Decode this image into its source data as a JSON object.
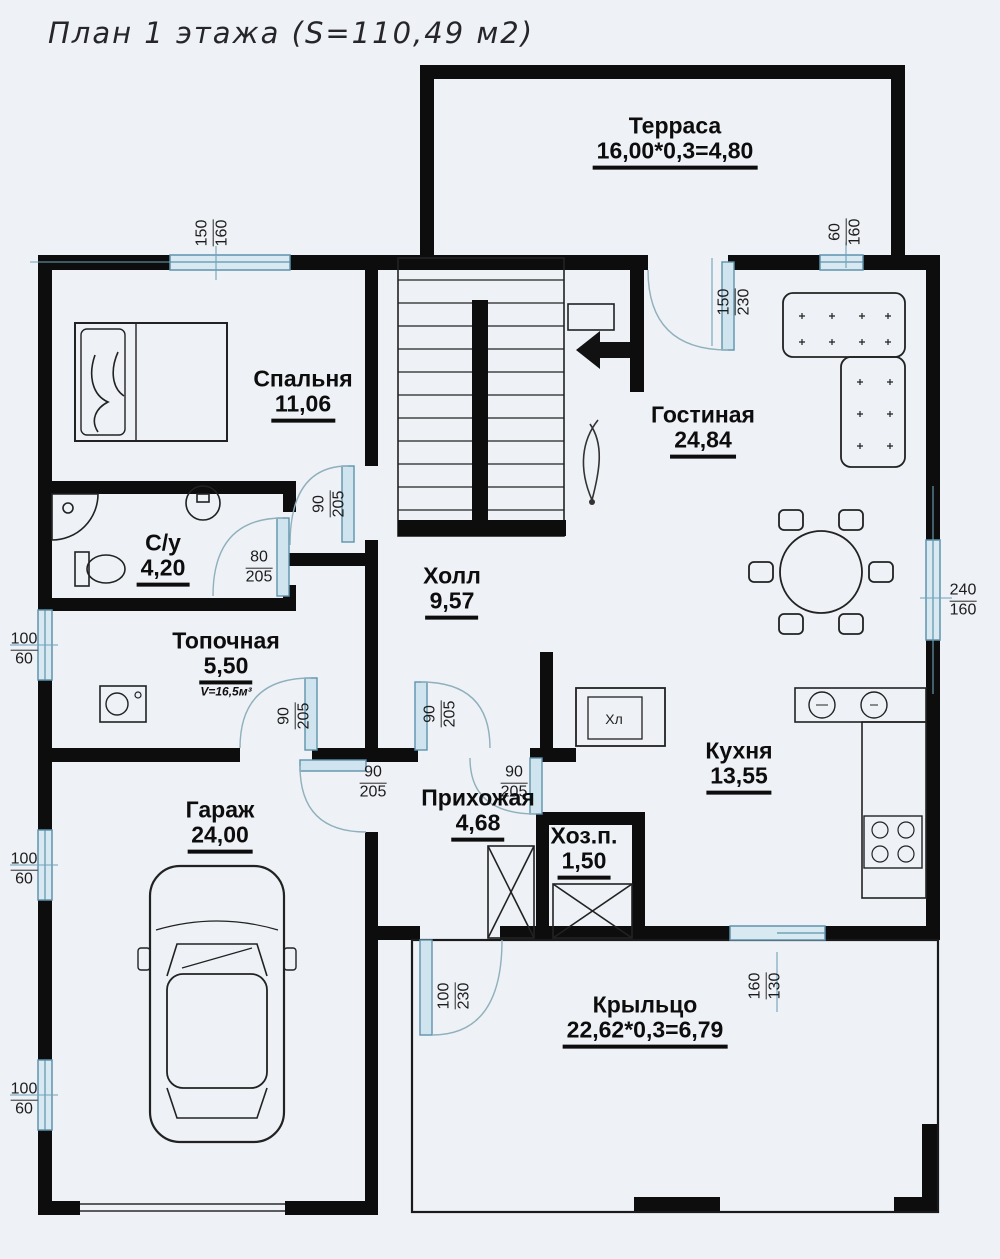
{
  "title": "План 1 этажа (S=110,49 м2)",
  "rooms": {
    "terrasa": {
      "name": "Терраса",
      "area": "16,00*0,3=4,80"
    },
    "spalnya": {
      "name": "Спальня",
      "area": "11,06"
    },
    "gostinaya": {
      "name": "Гостиная",
      "area": "24,84"
    },
    "su": {
      "name": "С/у",
      "area": "4,20"
    },
    "topochnaya": {
      "name": "Топочная",
      "area": "5,50",
      "volume": "V=16,5м³"
    },
    "holl": {
      "name": "Холл",
      "area": "9,57"
    },
    "kuhnya": {
      "name": "Кухня",
      "area": "13,55"
    },
    "garazh": {
      "name": "Гараж",
      "area": "24,00"
    },
    "prihozhaya": {
      "name": "Прихожая",
      "area": "4,68"
    },
    "hozp": {
      "name": "Хоз.п.",
      "area": "1,50"
    },
    "krylco": {
      "name": "Крыльцо",
      "area": "22,62*0,3=6,79"
    }
  },
  "dimensions": {
    "window_bedroom_top": {
      "w": "150",
      "h": "160"
    },
    "window_top_right": {
      "w": "60",
      "h": "160"
    },
    "door_terrace": {
      "w": "150",
      "h": "230"
    },
    "door_bedroom": {
      "w": "90",
      "h": "205"
    },
    "door_su": {
      "w": "80",
      "h": "205"
    },
    "window_living_right": {
      "w": "240",
      "h": "160"
    },
    "window_left_1": {
      "w": "100",
      "h": "60"
    },
    "window_left_2": {
      "w": "100",
      "h": "60"
    },
    "window_left_3": {
      "w": "100",
      "h": "60"
    },
    "door_topochnaya": {
      "w": "90",
      "h": "205"
    },
    "door_hall": {
      "w": "90",
      "h": "205"
    },
    "door_garage": {
      "w": "90",
      "h": "205"
    },
    "door_kitchen": {
      "w": "90",
      "h": "205"
    },
    "door_entrance": {
      "w": "100",
      "h": "230"
    },
    "window_kitchen_bottom": {
      "w": "160",
      "h": "130"
    }
  },
  "appliances": {
    "fridge_label": "Хл"
  },
  "colors": {
    "wall": "#0d0d0d",
    "glazing_stroke": "#5f93ad",
    "glazing_fill": "#d8e9f2",
    "door_arc": "#8fb0bc",
    "line": "#2b2b2b",
    "background": "#eef1f6"
  }
}
